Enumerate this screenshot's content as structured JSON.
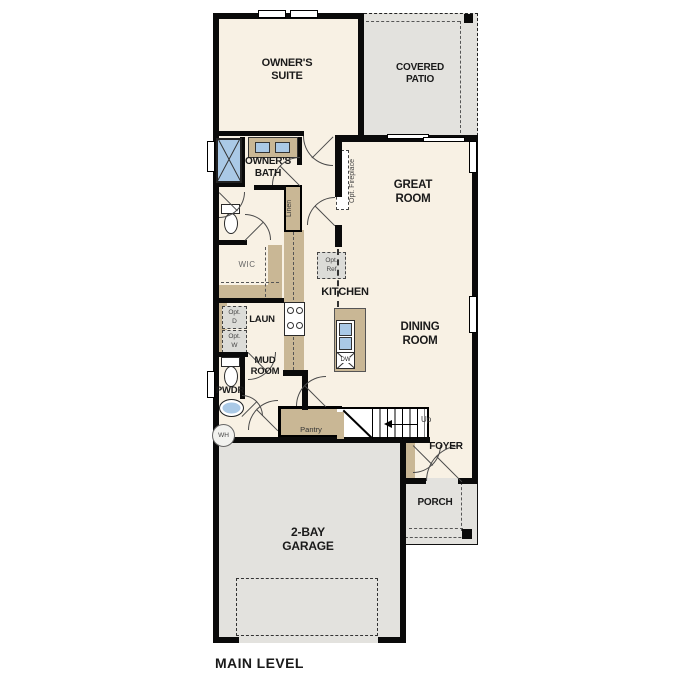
{
  "plan_title": "MAIN LEVEL",
  "colors": {
    "interior_floor": "#f8f1e4",
    "exterior_concrete": "#e3e2de",
    "casework_tan": "#c9b795",
    "fixture_blue": "#aac9e6",
    "wall_black": "#0a0a0a",
    "text": "#1a1a1a"
  },
  "rooms": {
    "owners_suite": {
      "line1": "OWNER'S",
      "line2": "SUITE"
    },
    "covered_patio": {
      "line1": "COVERED",
      "line2": "PATIO"
    },
    "owners_bath": {
      "line1": "OWNER'S",
      "line2": "BATH"
    },
    "great_room": {
      "line1": "GREAT",
      "line2": "ROOM"
    },
    "kitchen": {
      "label": "KITCHEN"
    },
    "dining_room": {
      "line1": "DINING",
      "line2": "ROOM"
    },
    "wic": {
      "label": "WIC"
    },
    "laundry": {
      "label": "LAUN"
    },
    "mud_room": {
      "line1": "MUD",
      "line2": "ROOM"
    },
    "powder": {
      "label": "PWDR"
    },
    "foyer": {
      "label": "FOYER"
    },
    "porch": {
      "label": "PORCH"
    },
    "garage": {
      "line1": "2-BAY",
      "line2": "GARAGE"
    },
    "pantry": {
      "label": "Pantry"
    },
    "linen": {
      "label": "Linen"
    }
  },
  "fixtures": {
    "opt_fireplace": "Opt. Fireplace",
    "opt_ref": {
      "line1": "Opt.",
      "line2": "Ref"
    },
    "opt_dryer": {
      "line1": "Opt.",
      "line2": "D"
    },
    "opt_washer": {
      "line1": "Opt.",
      "line2": "W"
    },
    "dishwasher": "DW",
    "water_heater": "WH",
    "stairs_direction": "Up"
  }
}
